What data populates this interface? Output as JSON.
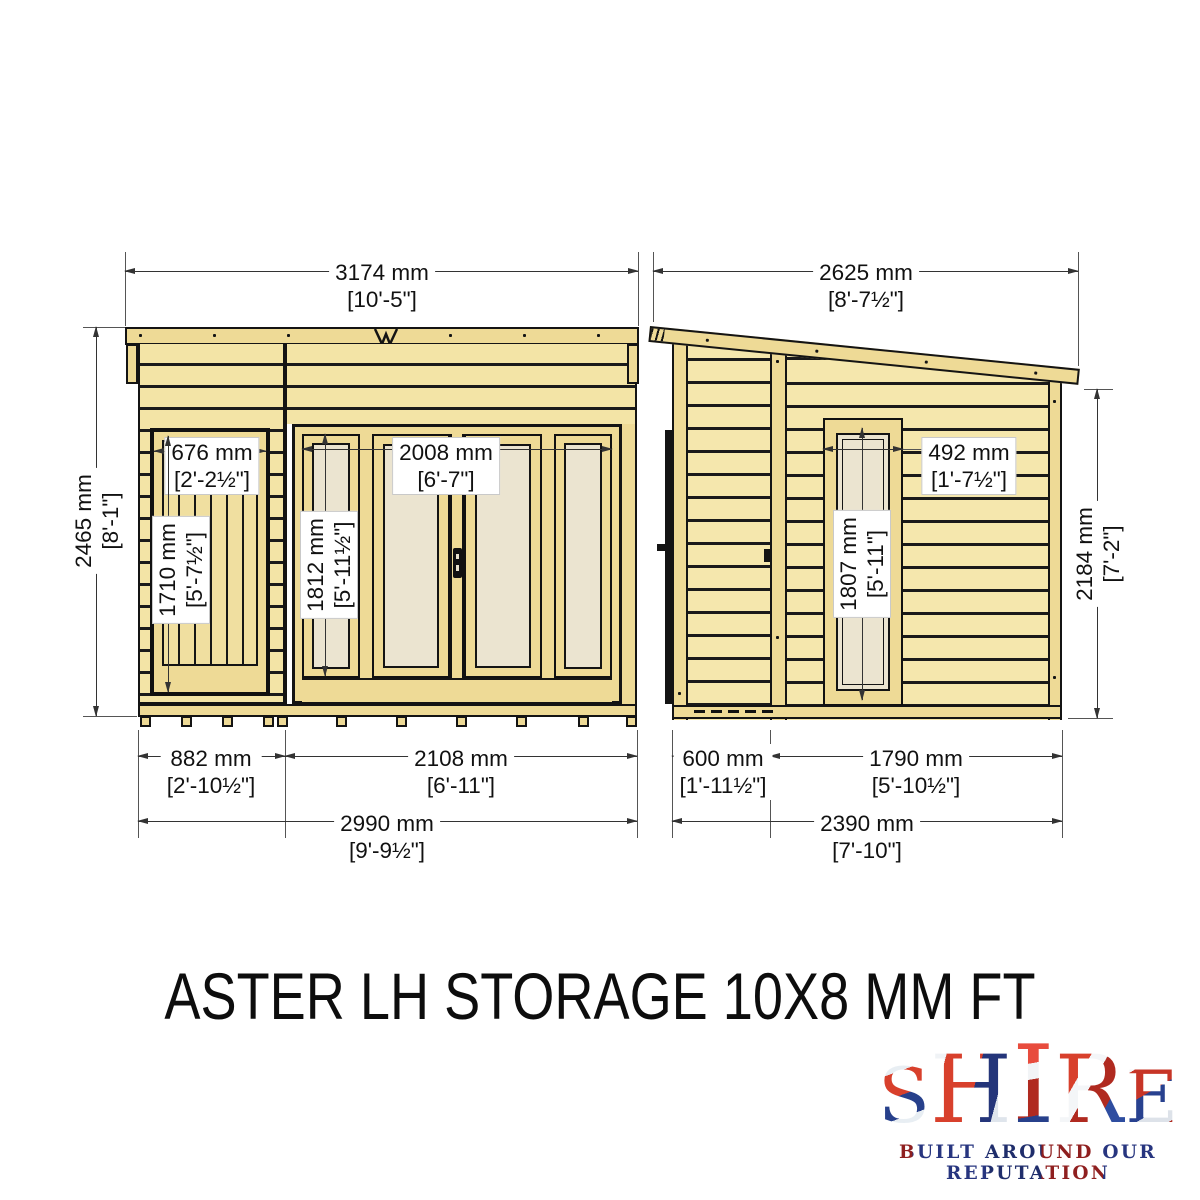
{
  "title": "ASTER LH STORAGE 10X8 MM FT",
  "logo": {
    "brand": "SHIRE",
    "tagline": "BUILT AROUND OUR REPUTATION"
  },
  "front": {
    "roof_w_mm": "3174 mm",
    "roof_w_ft": "[10'-5\"]",
    "height_mm": "2465 mm",
    "height_ft": "[8'-1\"]",
    "door_w_mm": "676 mm",
    "door_w_ft": "[2'-2½\"]",
    "door_h_mm": "1710 mm",
    "door_h_ft": "[5'-7½\"]",
    "glazing_w_mm": "2008 mm",
    "glazing_w_ft": "[6'-7\"]",
    "glazing_h_mm": "1812 mm",
    "glazing_h_ft": "[5'-11½\"]",
    "storage_w_mm": "882 mm",
    "storage_w_ft": "[2'-10½\"]",
    "main_w_mm": "2108 mm",
    "main_w_ft": "[6'-11\"]",
    "total_w_mm": "2990 mm",
    "total_w_ft": "[9'-9½\"]"
  },
  "side": {
    "roof_d_mm": "2625 mm",
    "roof_d_ft": "[8'-7½\"]",
    "window_w_mm": "492 mm",
    "window_w_ft": "[1'-7½\"]",
    "window_h_mm": "1807 mm",
    "window_h_ft": "[5'-11\"]",
    "height_mm": "2184 mm",
    "height_ft": "[7'-2\"]",
    "storage_d_mm": "600 mm",
    "storage_d_ft": "[1'-11½\"]",
    "main_d_mm": "1790 mm",
    "main_d_ft": "[5'-10½\"]",
    "total_d_mm": "2390 mm",
    "total_d_ft": "[7'-10\"]"
  }
}
